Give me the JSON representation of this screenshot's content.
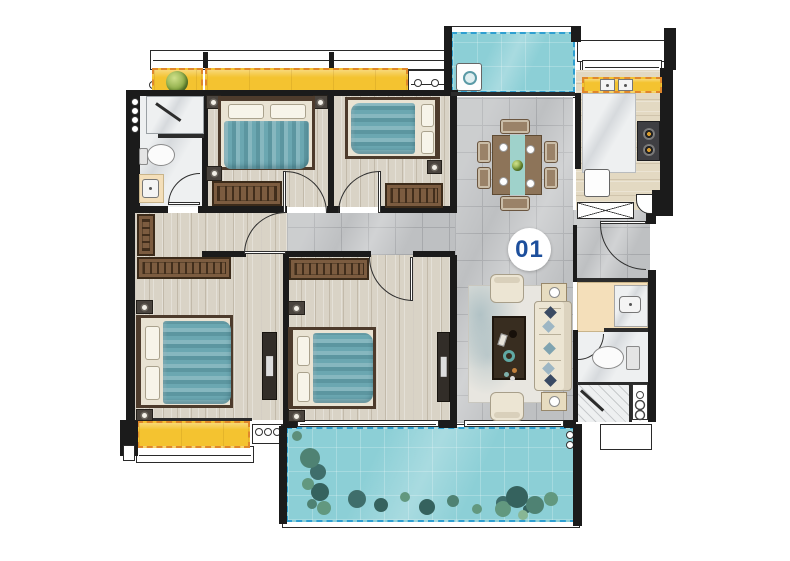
{
  "unit_badge": {
    "label": "01"
  },
  "palette": {
    "wall": "#1b1b1b",
    "label-blue": "#1d4f9c",
    "balcony-yellow": "#f4c330",
    "balcony-yellow-border": "#e0872b",
    "balcony-cyan": "#8ccfd6",
    "balcony-cyan-border": "#2e9fd1",
    "bed-blanket": "#6ba7b1",
    "wood-floor": "#d9d3c6",
    "tile-floor": "#bec0c2",
    "tile-line": "#a7a9ac",
    "marble-white": "#eef0f1",
    "vanity-beige": "#f4dfba",
    "wardrobe-brown": "#7c5c40",
    "furniture-cream": "#ece5d3",
    "rug": "#e8e6e0",
    "plant-green": "#4f8273"
  },
  "rooms": [
    {
      "name": "bathroom-top-left",
      "furniture": [
        "shower",
        "toilet",
        "washbasin"
      ]
    },
    {
      "name": "bedroom-top-left",
      "furniture": [
        "double-bed",
        "nightstands",
        "wardrobe",
        "tv-panel"
      ]
    },
    {
      "name": "bedroom-top-right",
      "furniture": [
        "double-bed",
        "nightstand",
        "wardrobe"
      ]
    },
    {
      "name": "laundry-balcony",
      "furniture": [
        "washing-machine"
      ]
    },
    {
      "name": "kitchen",
      "furniture": [
        "double-sink",
        "counter",
        "gas-stove",
        "fridge"
      ]
    },
    {
      "name": "dining-area",
      "furniture": [
        "dining-table-with-6-chairs"
      ]
    },
    {
      "name": "entry",
      "furniture": [
        "shoe-cabinet",
        "entry-door"
      ]
    },
    {
      "name": "living-room",
      "furniture": [
        "sofa",
        "armchairs",
        "coffee-table",
        "side-tables",
        "rug"
      ]
    },
    {
      "name": "master-bedroom",
      "furniture": [
        "double-bed",
        "wardrobes",
        "tv-stand",
        "bay-window-seat"
      ]
    },
    {
      "name": "bedroom-bottom-middle",
      "furniture": [
        "double-bed",
        "wardrobe",
        "tv-stand"
      ]
    },
    {
      "name": "bathroom-right",
      "furniture": [
        "washbasin",
        "toilet",
        "shower",
        "water-heater"
      ]
    },
    {
      "name": "garden-balcony",
      "furniture": [
        "plants",
        "shrubs"
      ]
    }
  ],
  "icons": {
    "washing-machine-icon": "square-with-drum-circle",
    "stove-icon": "dark-panel-with-burner-rings",
    "kitchen-sink-icon": "double-basin-rects",
    "fridge-icon": "white-rounded-square",
    "toilet-icon": "ellipse-bowl-with-tank",
    "washbasin-icon": "rounded-rect-with-drain",
    "shower-door-icon": "diagonal-bar",
    "water-heater-icon": "panel-with-three-rings",
    "shoe-cabinet-icon": "x-crossed-box",
    "plant-icon": "green-circle",
    "dining-plate-icon": "white-ring",
    "pipe-icon": "small-ring"
  }
}
